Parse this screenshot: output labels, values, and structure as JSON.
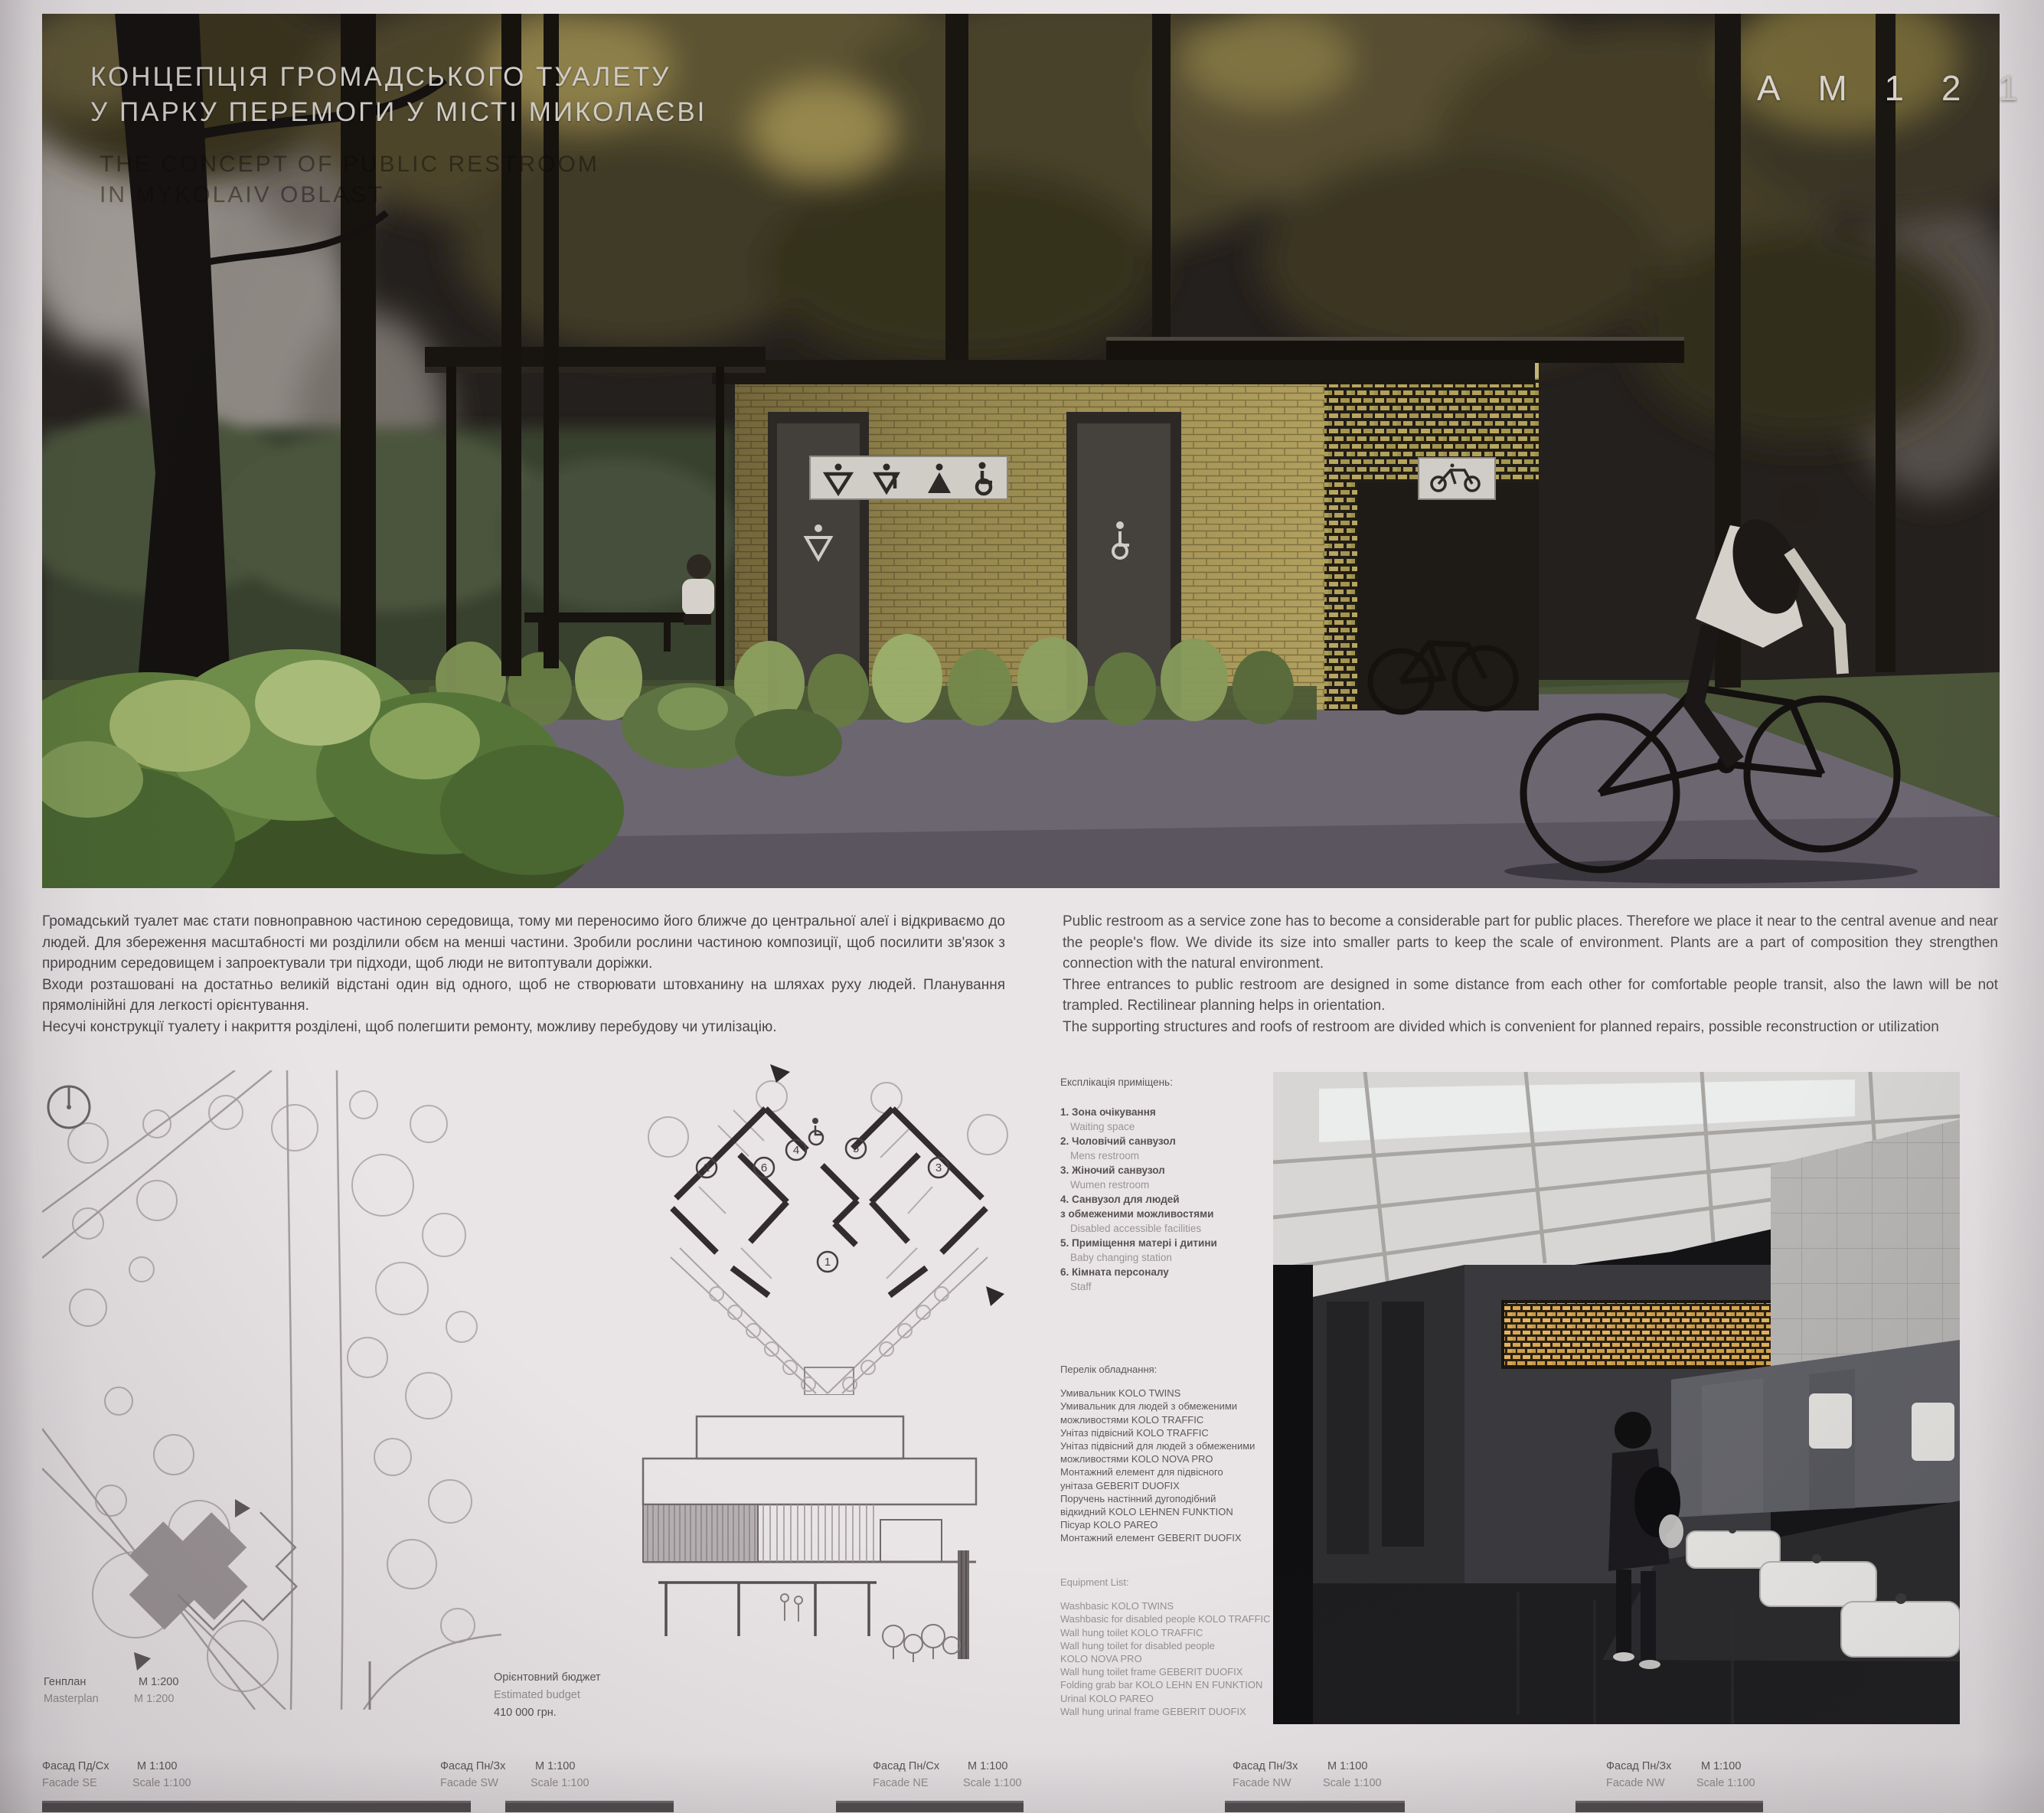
{
  "board": {
    "code": "А М 1 2 1 5",
    "title_line1": "КОНЦЕПЦІЯ ГРОМАДСЬКОГО ТУАЛЕТУ",
    "title_line2": "У ПАРКУ ПЕРЕМОГИ У МІСТІ МИКОЛАЄВІ",
    "subtitle_line1": "THE CONCEPT OF PUBLIC RESTROOM",
    "subtitle_line2": "IN MYKOLAIV OBLAST"
  },
  "intro": {
    "uk": [
      "Громадський туалет має стати повноправною частиною середовища, тому ми переносимо його ближче до центральної алеї і відкриваємо до людей. Для збереження масштабності ми розділили  обєм на менші частини. Зробили рослини частиною композиції, щоб посилити зв'язок з природним середовищем і запроектували три підходи, щоб люди не витоптували доріжки.",
      "Входи розташовані на достатньо великій відстані один від одного, щоб не створювати штовханину на шляхах руху людей. Планування прямолінійні для легкості орієнтування.",
      "Несучі конструкції туалету і накриття розділені, щоб полегшити ремонту, можливу перебудову чи утилізацію."
    ],
    "en": [
      "Public restroom as a service zone has to become a considerable part for public places. Therefore we place it near to the central avenue and near the people's flow. We divide its size into smaller parts to keep the scale of environment. Plants are a part of composition they strengthen connection with the natural environment.",
      "Three entrances to public restroom are designed in some distance from each other for comfortable people transit, also the lawn will be not trampled. Rectilinear planning helps in orientation.",
      "The supporting structures and roofs of restroom are divided which is convenient for planned repairs, possible reconstruction or utilization"
    ]
  },
  "rooms": {
    "title": "Експлікація приміщень:",
    "items": [
      {
        "num": "1.",
        "uk": "Зона очікування",
        "en": "Waiting space"
      },
      {
        "num": "2.",
        "uk": "Чоловічий санвузол",
        "en": "Mens restroom"
      },
      {
        "num": "3.",
        "uk": "Жіночий санвузол",
        "en": "Wumen restroom"
      },
      {
        "num": "4.",
        "uk": "Санвузол для людей",
        "uk2": "з обмеженими можливостями",
        "en": "Disabled accessible facilities"
      },
      {
        "num": "5.",
        "uk": "Приміщення матері і дитини",
        "en": "Baby changing station"
      },
      {
        "num": "6.",
        "uk": "Кімната персоналу",
        "en": "Staff"
      }
    ]
  },
  "equipment_uk": {
    "title": "Перелік обладнання:",
    "rows": [
      {
        "t": "Умивальник  KOLO TWINS",
        "q": "8 шт."
      },
      {
        "t": "Умивальник для людей з обмеженими",
        "q": ""
      },
      {
        "t": "можливостями KOLO TRAFFIC",
        "q": "1 шт."
      },
      {
        "t": "Унітаз підвісний KOLO TRAFFIC",
        "q": "7 шт."
      },
      {
        "t": "Унітаз підвісний для людей з обмеженими",
        "q": ""
      },
      {
        "t": "можливостями KOLO NOVA PRO",
        "q": "1 шт."
      },
      {
        "t": "Монтажний елемент для підвісного",
        "q": ""
      },
      {
        "t": "унітаза GEBERIT DUOFIX",
        "q": "8 шт."
      },
      {
        "t": "Поручень настінний дугоподібний",
        "q": ""
      },
      {
        "t": "відкидний KOLO LEHNEN FUNKTION",
        "q": "1 шт."
      },
      {
        "t": "Пісуар KOLO PAREO",
        "q": "3 шт."
      },
      {
        "t": "Монтажний елемент GEBERIT DUOFIX",
        "q": "3 шт."
      }
    ]
  },
  "equipment_en": {
    "title": "Equipment List:",
    "rows": [
      {
        "t": "Washbasic  KOLO TWINS",
        "q": "8 pc."
      },
      {
        "t": "Washbasic for disabled people  KOLO TRAFFIC",
        "q": "1 pc."
      },
      {
        "t": "Wall hung toilet KOLO TRAFFIC",
        "q": "7 pc."
      },
      {
        "t": "Wall hung toilet for disabled people",
        "q": ""
      },
      {
        "t": "KOLO NOVA PRO",
        "q": "1 pc."
      },
      {
        "t": "Wall hung toilet frame GEBERIT DUOFIX",
        "q": "8 pc."
      },
      {
        "t": "Folding grab bar KOLO LEHN EN FUNKTION",
        "q": "1 pc."
      },
      {
        "t": "Urinal KOLO PAREO",
        "q": "3 pc."
      },
      {
        "t": "Wall hung urinal frame GEBERIT DUOFIX",
        "q": "3 pc."
      }
    ]
  },
  "drawings": {
    "genplan": {
      "uk": "Генплан",
      "uk_scale": "М 1:200",
      "en": "Masterplan",
      "en_scale": "M 1:200"
    },
    "budget": {
      "uk": "Орієнтовний бюджет",
      "en": "Estimated budget",
      "value": "410 000 грн."
    },
    "facades": [
      {
        "uk": "Фасад Пд/Сх",
        "uk_scale": "М 1:100",
        "en": "Facade SE",
        "en_scale": "Scale 1:100"
      },
      {
        "uk": "Фасад Пн/Зх",
        "uk_scale": "М 1:100",
        "en": "Facade SW",
        "en_scale": "Scale 1:100"
      },
      {
        "uk": "Фасад Пн/Сх",
        "uk_scale": "М 1:100",
        "en": "Facade NE",
        "en_scale": "Scale 1:100"
      },
      {
        "uk": "Фасад Пн/Зх",
        "uk_scale": "М 1:100",
        "en": "Facade NW",
        "en_scale": "Scale 1:100"
      },
      {
        "uk": "Фасад Пн/Зх",
        "uk_scale": "М 1:100",
        "en": "Facade NW",
        "en_scale": "Scale 1:100"
      }
    ]
  },
  "plan": {
    "numbers": [
      "1",
      "2",
      "3",
      "4",
      "5",
      "6"
    ]
  },
  "colors": {
    "brick": "#b1a05e",
    "lattice_glow": "#d8a74e",
    "sign_background": "#d0cdc7",
    "grass": "#424c31",
    "pavement": "#6c6671"
  }
}
